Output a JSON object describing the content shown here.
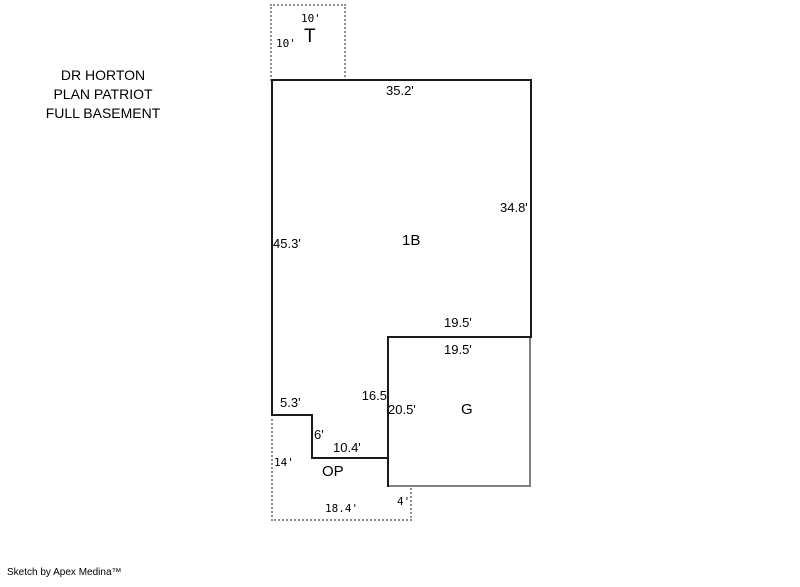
{
  "title": {
    "line1": "DR HORTON",
    "line2": "PLAN PATRIOT",
    "line3": "FULL BASEMENT"
  },
  "footer": "Sketch by Apex Medina™",
  "areas": {
    "terrace": "T",
    "main": "1B",
    "garage": "G",
    "open_porch": "OP"
  },
  "dims": {
    "t_top": "10'",
    "t_left": "10'",
    "main_top": "35.2'",
    "main_right": "34.8'",
    "main_left": "45.3'",
    "main_bottom_right": "19.5'",
    "garage_top": "19.5'",
    "garage_left_upper": "16.5",
    "garage_left_full": "20.5'",
    "step_top": "5.3'",
    "step_side": "6'",
    "porch_top": "10.4'",
    "porch_left": "14'",
    "porch_bottom": "18.4'",
    "porch_right": "4'"
  },
  "colors": {
    "wall": "#1a1a1a",
    "garage_accent": "#808080",
    "dashed": "#8f8f8f",
    "background": "#ffffff"
  }
}
